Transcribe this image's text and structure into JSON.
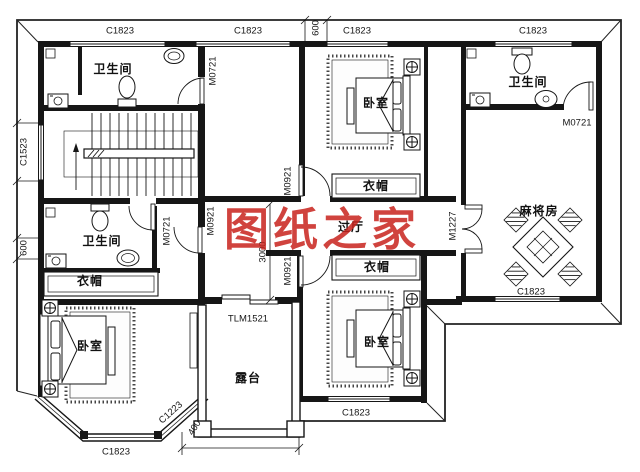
{
  "watermark": {
    "text": "图纸之家",
    "color": "#c8231d"
  },
  "rooms": {
    "bathroom": "卫生间",
    "bedroom": "卧室",
    "cloakroom": "衣帽",
    "hallway": "过厅",
    "mahjong_room": "麻将房",
    "terrace": "露台"
  },
  "windows": {
    "c1823": "C1823",
    "c1523": "C1523",
    "c1223": "C1223"
  },
  "doors": {
    "m0721": "M0721",
    "m0921": "M0921",
    "m1227": "M1227",
    "tlm1521": "TLM1521"
  },
  "dimensions": {
    "six_hundred": "600",
    "three_thousand": "3000",
    "four_hundred": "400"
  }
}
